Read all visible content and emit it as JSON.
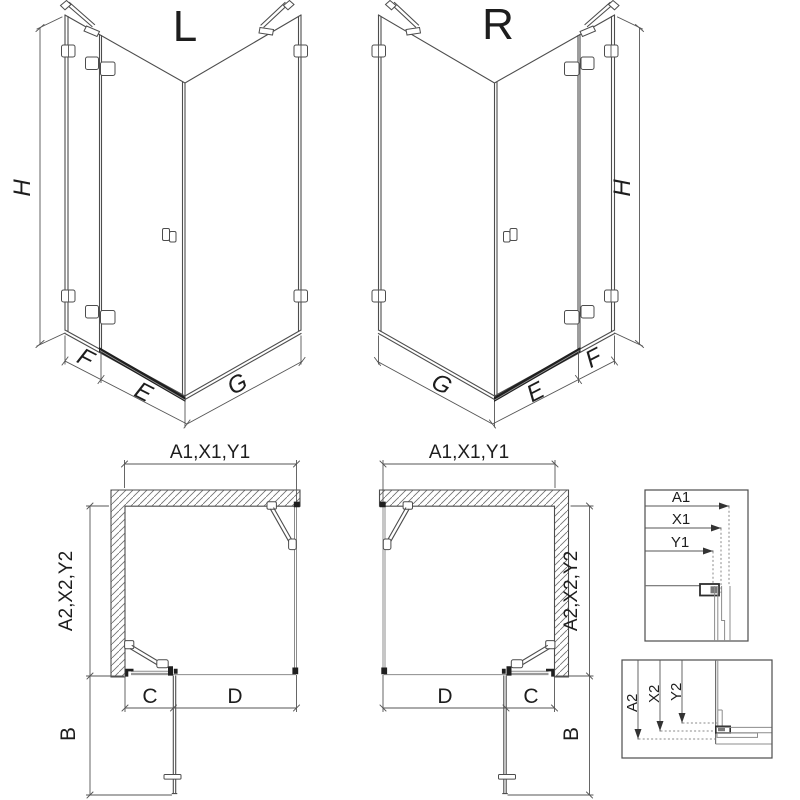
{
  "iso_left": {
    "title": "L",
    "h": "H",
    "f": "F",
    "e": "E",
    "g": "G"
  },
  "iso_right": {
    "title": "R",
    "h": "H",
    "f": "F",
    "e": "E",
    "g": "G"
  },
  "plan_left": {
    "width": "A1,X1,Y1",
    "depth": "A2,X2,Y2",
    "c": "C",
    "d": "D",
    "b": "B"
  },
  "plan_right": {
    "width": "A1,X1,Y1",
    "depth": "A2,X2,Y2",
    "c": "C",
    "d": "D",
    "b": "B"
  },
  "detail_top": {
    "a1": "A1",
    "x1": "X1",
    "y1": "Y1"
  },
  "detail_bottom": {
    "a2": "A2",
    "x2": "X2",
    "y2": "Y2"
  },
  "colors": {
    "line": "#4d4d4d",
    "glass": "#8c8c8c",
    "fittings": "#1f1f1f",
    "text": "#1d1d1d",
    "background": "#ffffff"
  }
}
